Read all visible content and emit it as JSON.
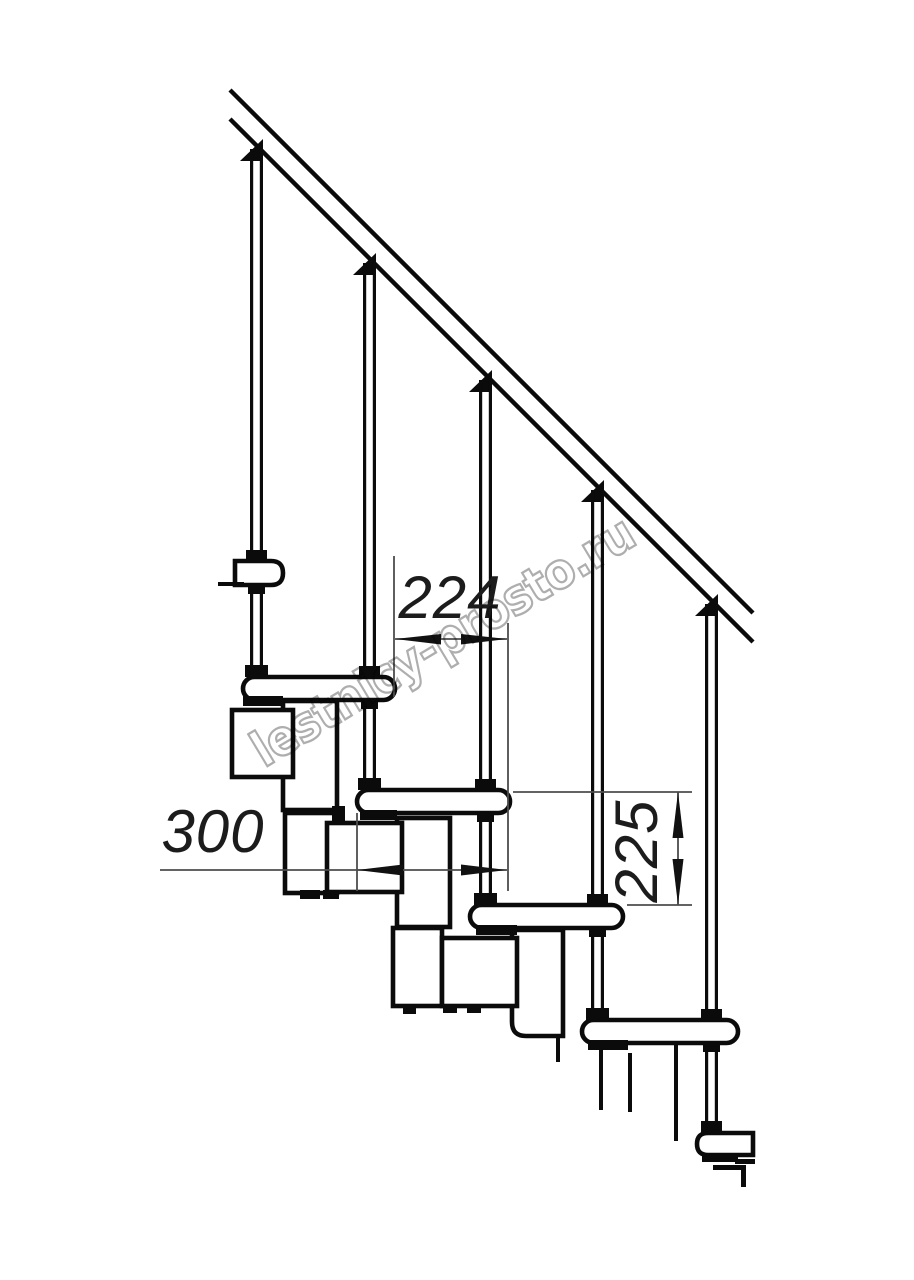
{
  "drawing": {
    "type": "modular-staircase-side-view",
    "watermark_text": "lestnicy-prosto.ru",
    "dimensions": {
      "step_run_label": "224",
      "tread_depth_label": "300",
      "step_rise_label": "225"
    },
    "colors": {
      "background": "#ffffff",
      "outline": "#0b0b0b",
      "dimension_line": "#4d4d4d",
      "dimension_text": "#1c1c1c",
      "watermark_outline": "#aeaeae"
    }
  }
}
